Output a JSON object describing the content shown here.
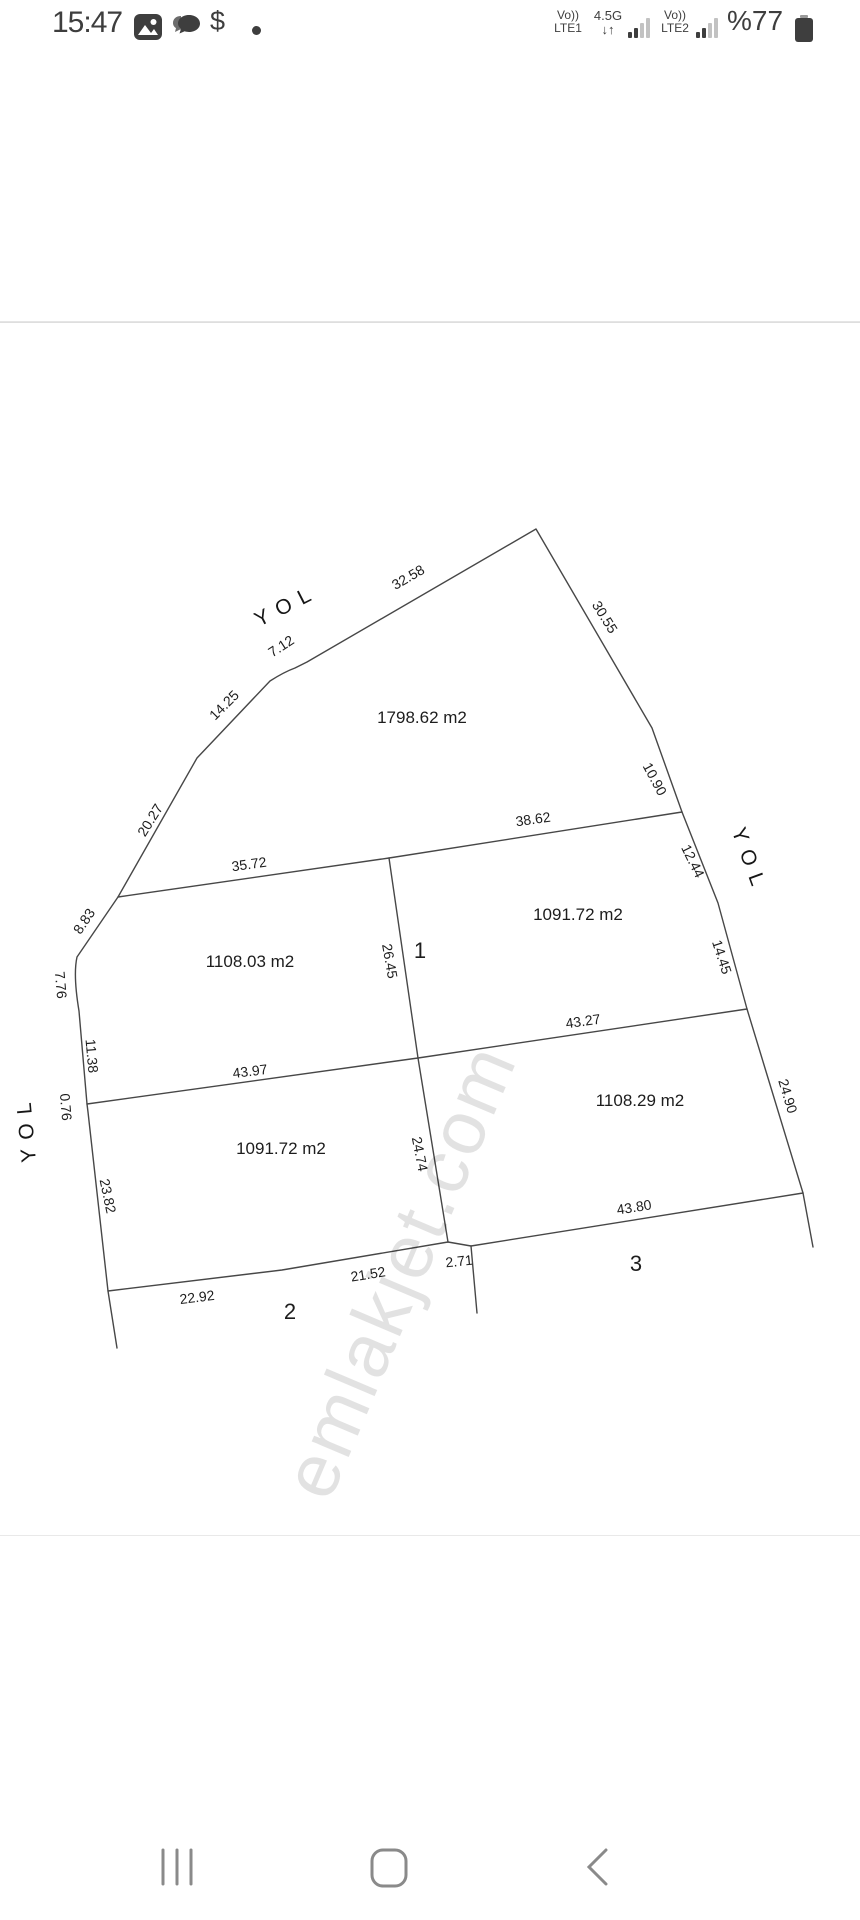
{
  "status_bar": {
    "time": "15:47",
    "dollar": "$",
    "carrier1_vo": "Vo))",
    "carrier1_lte": "LTE1",
    "network": "4.5G",
    "arrows": "↓↑",
    "carrier2_vo": "Vo))",
    "carrier2_lte": "LTE2",
    "battery_text": "%77"
  },
  "diagram": {
    "watermark": "emlakjet.com",
    "road_labels": [
      {
        "t": "YOL",
        "x": 287,
        "y": 606,
        "r": -27
      },
      {
        "t": "YOL",
        "x": 749,
        "y": 861,
        "r": 70
      },
      {
        "t": "YOL",
        "x": 27,
        "y": 1128,
        "r": -95
      }
    ],
    "edge_lengths": [
      {
        "t": "32.58",
        "x": 408,
        "y": 577,
        "r": -30
      },
      {
        "t": "30.55",
        "x": 605,
        "y": 617,
        "r": 58
      },
      {
        "t": "7.12",
        "x": 281,
        "y": 646,
        "r": -33
      },
      {
        "t": "14.25",
        "x": 224,
        "y": 705,
        "r": -45
      },
      {
        "t": "20.27",
        "x": 150,
        "y": 820,
        "r": -58
      },
      {
        "t": "8.83",
        "x": 84,
        "y": 921,
        "r": -56
      },
      {
        "t": "7.76",
        "x": 61,
        "y": 985,
        "r": 85
      },
      {
        "t": "11.38",
        "x": 92,
        "y": 1056,
        "r": 85
      },
      {
        "t": "0.76",
        "x": 66,
        "y": 1107,
        "r": 85
      },
      {
        "t": "23.82",
        "x": 108,
        "y": 1196,
        "r": 78
      },
      {
        "t": "10.90",
        "x": 655,
        "y": 779,
        "r": 62
      },
      {
        "t": "12.44",
        "x": 693,
        "y": 861,
        "r": 64
      },
      {
        "t": "14.45",
        "x": 722,
        "y": 957,
        "r": 72
      },
      {
        "t": "24.90",
        "x": 788,
        "y": 1096,
        "r": 73
      },
      {
        "t": "38.62",
        "x": 533,
        "y": 819,
        "r": -8
      },
      {
        "t": "35.72",
        "x": 249,
        "y": 864,
        "r": -8
      },
      {
        "t": "26.45",
        "x": 390,
        "y": 961,
        "r": 80
      },
      {
        "t": "43.97",
        "x": 250,
        "y": 1071,
        "r": -7
      },
      {
        "t": "43.27",
        "x": 583,
        "y": 1021,
        "r": -8
      },
      {
        "t": "24.74",
        "x": 420,
        "y": 1154,
        "r": 79
      },
      {
        "t": "43.80",
        "x": 634,
        "y": 1207,
        "r": -9
      },
      {
        "t": "2.71",
        "x": 459,
        "y": 1261,
        "r": -6
      },
      {
        "t": "21.52",
        "x": 368,
        "y": 1274,
        "r": -9
      },
      {
        "t": "22.92",
        "x": 197,
        "y": 1297,
        "r": -7
      }
    ],
    "areas": [
      {
        "t": "1798.62 m2",
        "x": 422,
        "y": 718,
        "r": 0
      },
      {
        "t": "1091.72 m2",
        "x": 578,
        "y": 915,
        "r": 0
      },
      {
        "t": "1108.03 m2",
        "x": 250,
        "y": 962,
        "r": 0
      },
      {
        "t": "1108.29 m2",
        "x": 640,
        "y": 1101,
        "r": 0
      },
      {
        "t": "1091.72 m2",
        "x": 281,
        "y": 1149,
        "r": 0
      }
    ],
    "parcel_numbers": [
      {
        "t": "1",
        "x": 420,
        "y": 951,
        "r": 0
      },
      {
        "t": "2",
        "x": 290,
        "y": 1312,
        "r": 0
      },
      {
        "t": "3",
        "x": 636,
        "y": 1264,
        "r": 0
      }
    ]
  }
}
